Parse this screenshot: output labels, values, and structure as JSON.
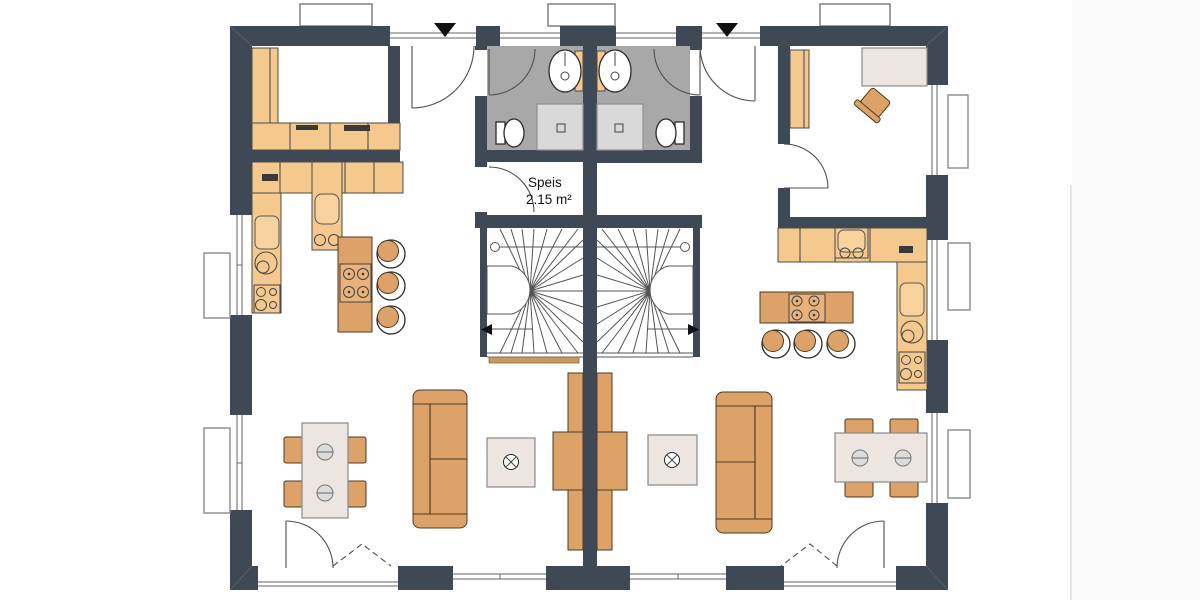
{
  "page": {
    "type": "floor-plan",
    "background": "#ffffff",
    "units": 2,
    "style": "semi-detached duplex ground floor"
  },
  "rooms": {
    "speis": {
      "label": "Speis",
      "area": "2.15 m²"
    }
  },
  "colors": {
    "wall": "#3f4956",
    "counter": "#f5c98e",
    "tan": "#dda268",
    "table": "#ece5e1",
    "bath": "#a8a8a8",
    "shower": "#d9d9d9",
    "edge": "#4a4a4a",
    "line": "#666666",
    "arc": "#4f4f4f",
    "stair": "#555555",
    "wood": "#c59a62",
    "text": "#111111"
  },
  "annotations": {
    "entrance_markers": 2,
    "stair_direction_arrows": 2,
    "chimney_blocks": 1,
    "roof_dormer_boxes": 3
  },
  "left_unit": {
    "rooms": [
      "utility-room",
      "hallway",
      "bathroom",
      "pantry-speis",
      "kitchen",
      "living-dining"
    ],
    "fixtures": [
      "kitchen-counter",
      "sink",
      "round-basin",
      "cooktop",
      "kitchen-island",
      "bar-stool",
      "bar-stool",
      "bar-stool",
      "dining-table",
      "chair",
      "chair",
      "chair",
      "chair",
      "sofa",
      "side-table",
      "tv-sideboard",
      "winder-staircase",
      "washbasin",
      "toilet",
      "shower"
    ]
  },
  "right_unit": {
    "rooms": [
      "office",
      "hallway",
      "bathroom",
      "kitchen",
      "living-dining"
    ],
    "fixtures": [
      "desk",
      "office-chair",
      "wardrobe",
      "kitchen-counter",
      "sink",
      "round-basin",
      "cooktop",
      "kitchen-island",
      "bar-stool",
      "bar-stool",
      "bar-stool",
      "dining-table",
      "chair",
      "chair",
      "chair",
      "chair",
      "sofa",
      "side-table",
      "tv-sideboard",
      "winder-staircase",
      "washbasin",
      "toilet",
      "shower"
    ]
  }
}
